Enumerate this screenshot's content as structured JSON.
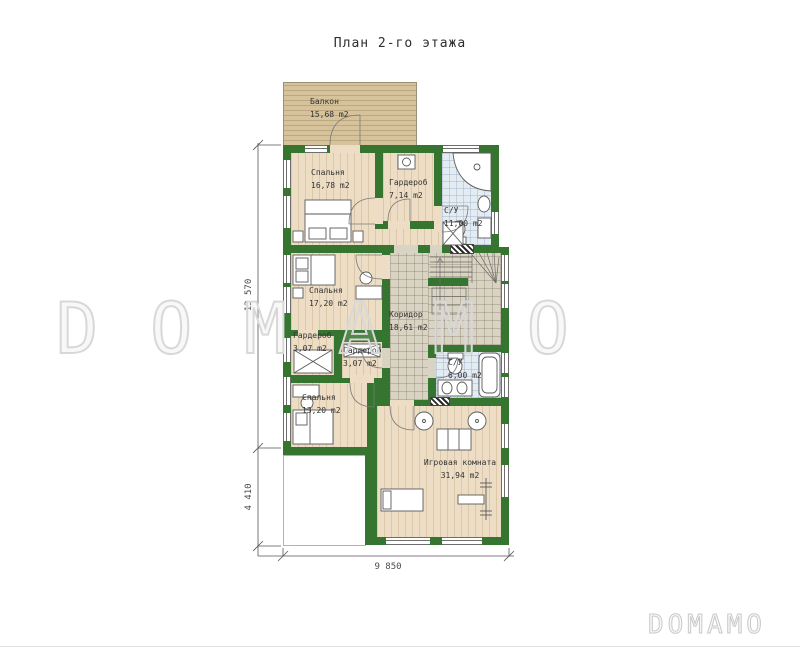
{
  "title": "План 2-го этажа",
  "watermark": {
    "center": "DOMAMO",
    "corner": "DOMAMO"
  },
  "rooms": [
    {
      "id": "balcony",
      "name": "Балкон",
      "area": "15,68 m2"
    },
    {
      "id": "bedroom1",
      "name": "Спальня",
      "area": "16,78 m2"
    },
    {
      "id": "wardrobe1",
      "name": "Гардероб",
      "area": "7,14 m2"
    },
    {
      "id": "bath1",
      "name": "С/У",
      "area": "11,00 m2"
    },
    {
      "id": "bedroom2",
      "name": "Спальня",
      "area": "17,20 m2"
    },
    {
      "id": "corridor",
      "name": "Коридор",
      "area": "18,61 m2"
    },
    {
      "id": "wardrobe2",
      "name": "Гардероб",
      "area": "3,07 m2"
    },
    {
      "id": "wardrobe3",
      "name": "Гардероб",
      "area": "3,07 m2"
    },
    {
      "id": "bath2",
      "name": "С/У",
      "area": "6,00 m2"
    },
    {
      "id": "bedroom3",
      "name": "Спальня",
      "area": "13,20 m2"
    },
    {
      "id": "playroom",
      "name": "Игровая комната",
      "area": "31,94 m2"
    }
  ],
  "dimensions": {
    "left_upper": "13 570",
    "left_lower": "4 410",
    "bottom": "9 850"
  },
  "colors": {
    "wall_green": "#35752f",
    "wood_floor": "#ecddc4",
    "balcony_wood": "#d6c29b",
    "bath_tile": "#e4ecf3",
    "corridor_tile": "#d9d3c4",
    "watermark_gray": "#d8d8d8"
  }
}
